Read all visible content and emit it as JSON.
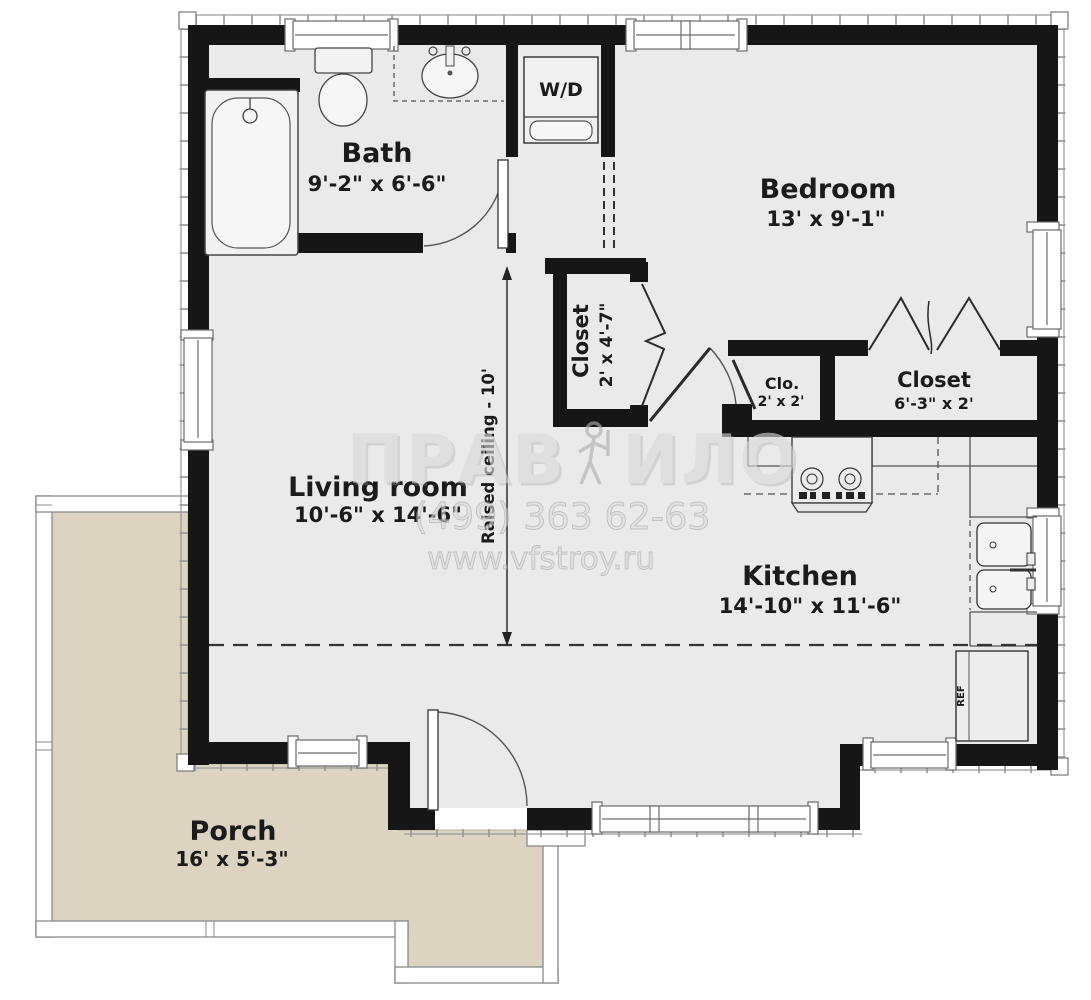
{
  "rooms": {
    "bath": {
      "label": "Bath",
      "dims": "9'-2\" x 6'-6\""
    },
    "bedroom": {
      "label": "Bedroom",
      "dims": "13' x 9'-1\""
    },
    "hall_closet": {
      "label": "Closet",
      "dims": "2' x 4'-7\""
    },
    "small_closet": {
      "label": "Clo.",
      "dims": "2' x 2'"
    },
    "bedroom_closet": {
      "label": "Closet",
      "dims": "6'-3\" x 2'"
    },
    "living_room": {
      "label": "Living room",
      "dims": "10'-6\" x 14'-6\""
    },
    "kitchen": {
      "label": "Kitchen",
      "dims": "14'-10\" x 11'-6\""
    },
    "porch": {
      "label": "Porch",
      "dims": "16' x 5'-3\""
    }
  },
  "appliances": {
    "washer_dryer": "W/D",
    "refrigerator": "REF"
  },
  "annotations": {
    "raised_ceiling": "Raised ceiling - 10'"
  },
  "watermark": {
    "brand_left": "ПРАВ",
    "brand_right": "ИЛО",
    "phone": "(499) 363 62-63",
    "website": "www.vfstroy.ru"
  },
  "colors": {
    "wall": "#161616",
    "floor": "#eaeaea",
    "porch": "#dcd4c0",
    "watermark_gray": "#d9d9d9"
  }
}
